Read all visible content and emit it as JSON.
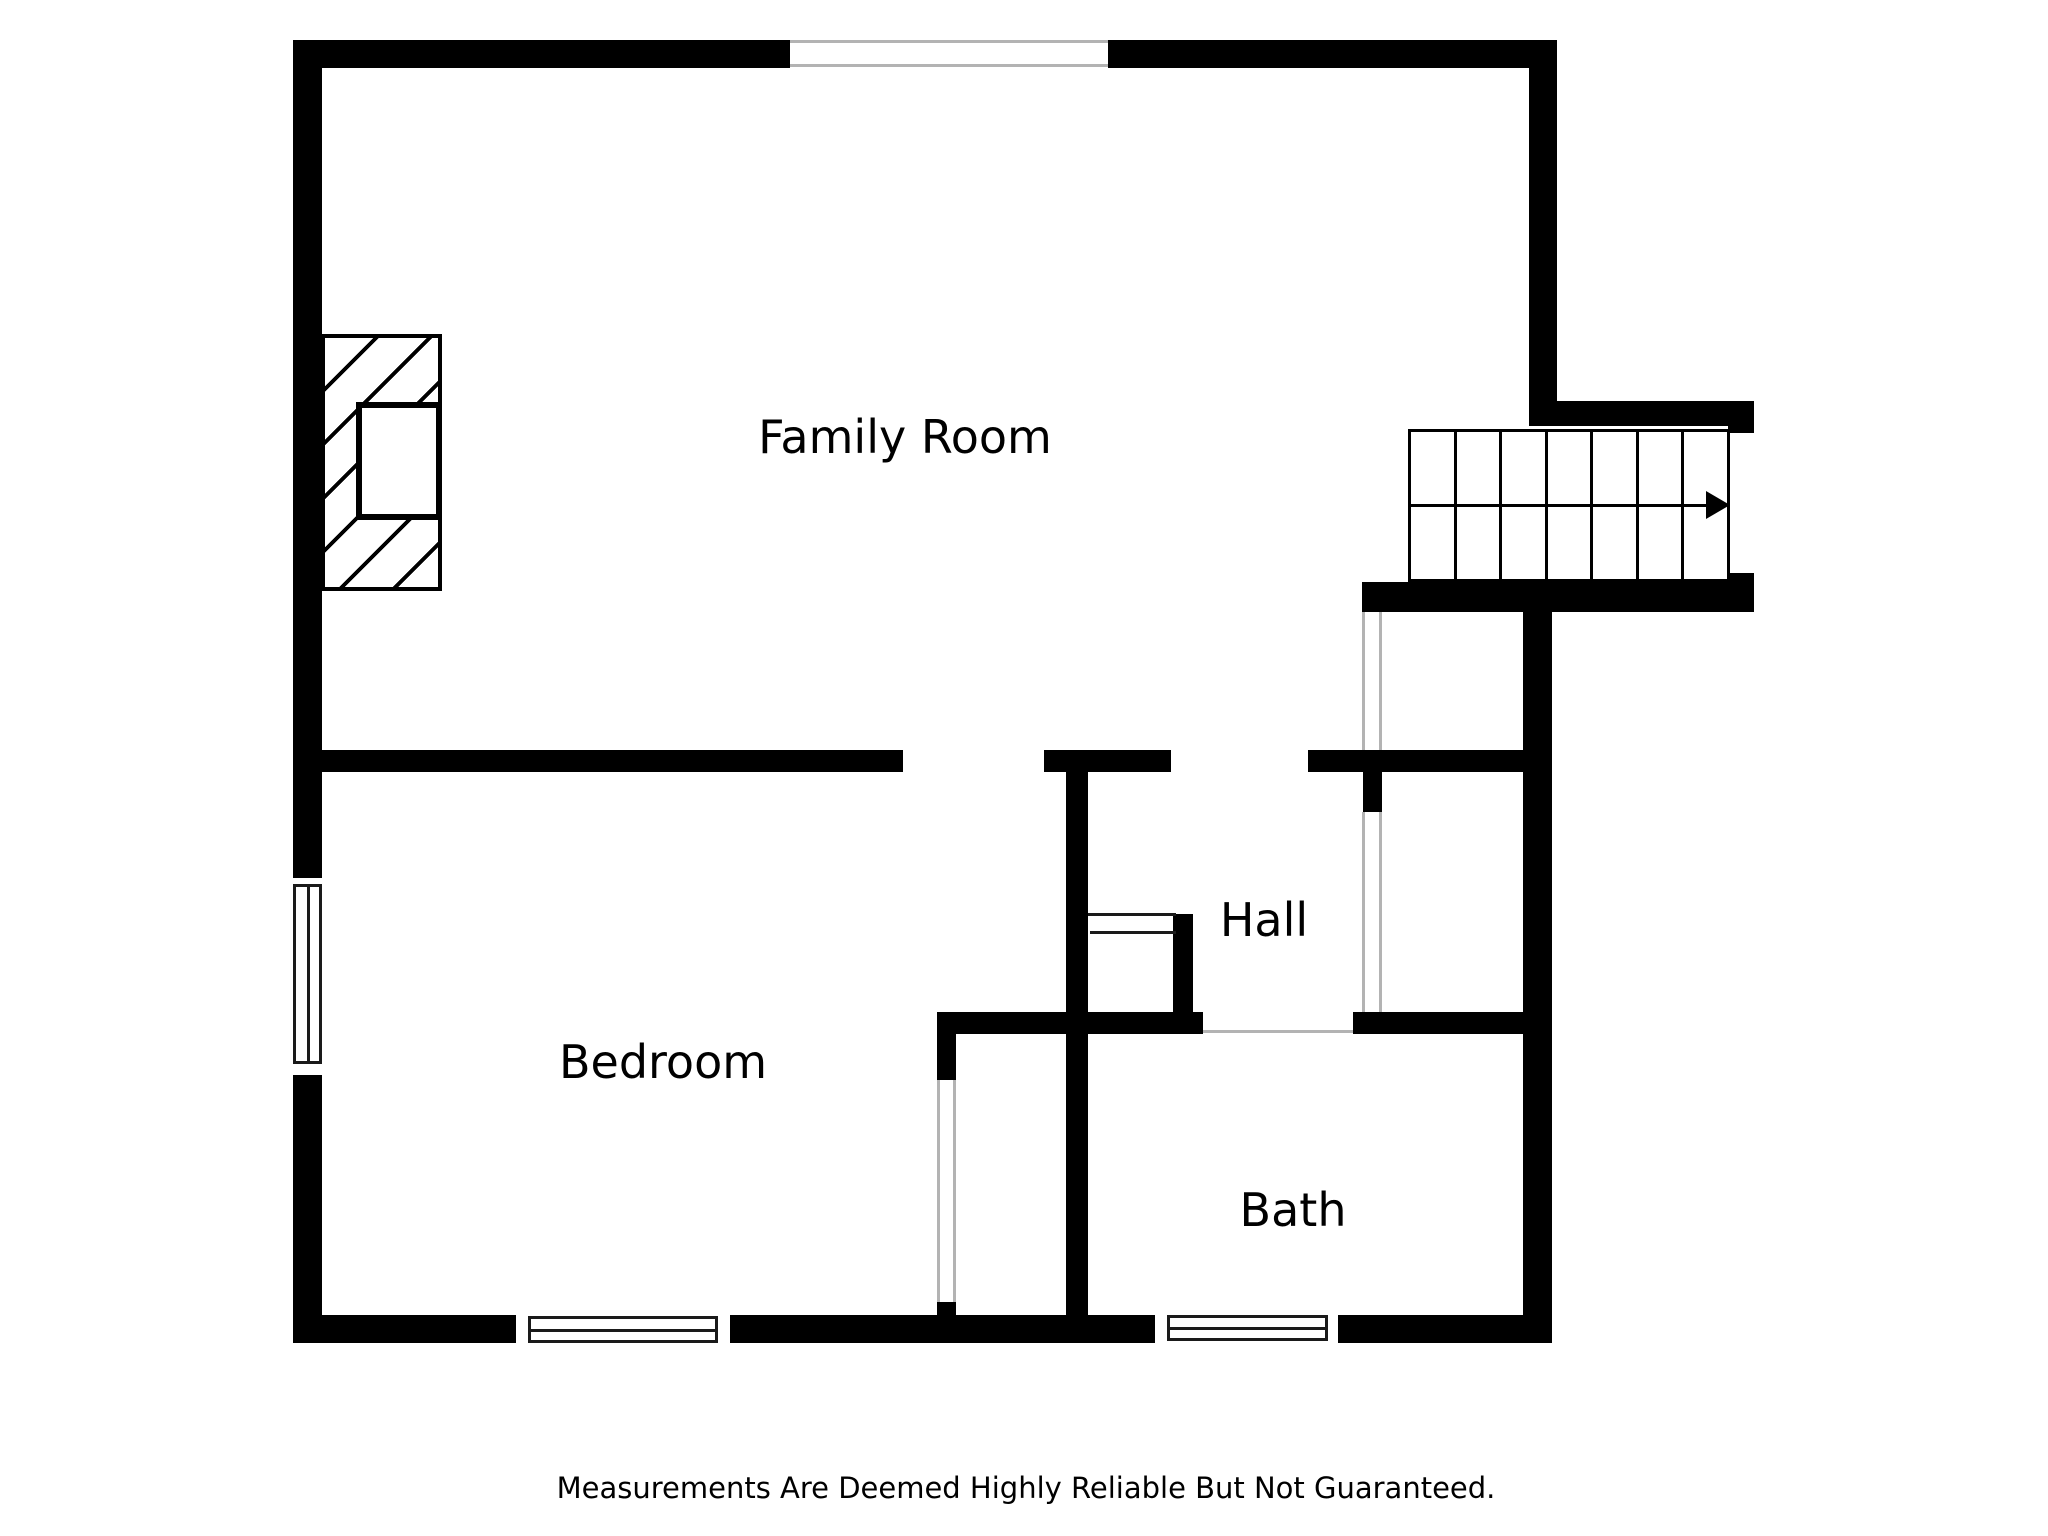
{
  "rooms": {
    "family_room": "Family Room",
    "hall": "Hall",
    "bedroom": "Bedroom",
    "bath": "Bath"
  },
  "disclaimer": "Measurements Are Deemed Highly Reliable But Not Guaranteed.",
  "stairs": {
    "tread_count": 7,
    "direction_arrow": "right"
  },
  "colors": {
    "wall": "#000000",
    "background": "#ffffff",
    "opening_line": "#b3b3b3",
    "window_frame": "#1a1a1a"
  }
}
